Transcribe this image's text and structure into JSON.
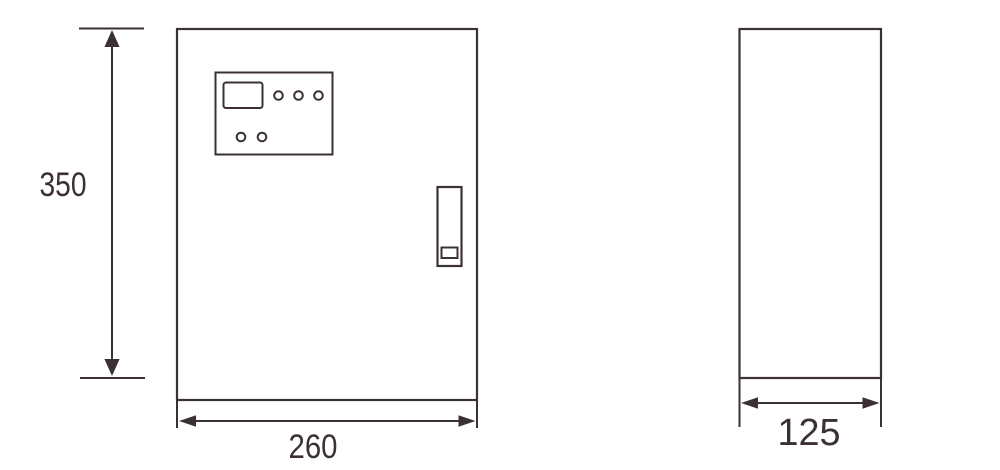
{
  "drawing": {
    "dimensions": {
      "height": "350",
      "width": "260",
      "depth": "125"
    },
    "colors": {
      "line": "#3b3133",
      "background": "#ffffff"
    }
  }
}
